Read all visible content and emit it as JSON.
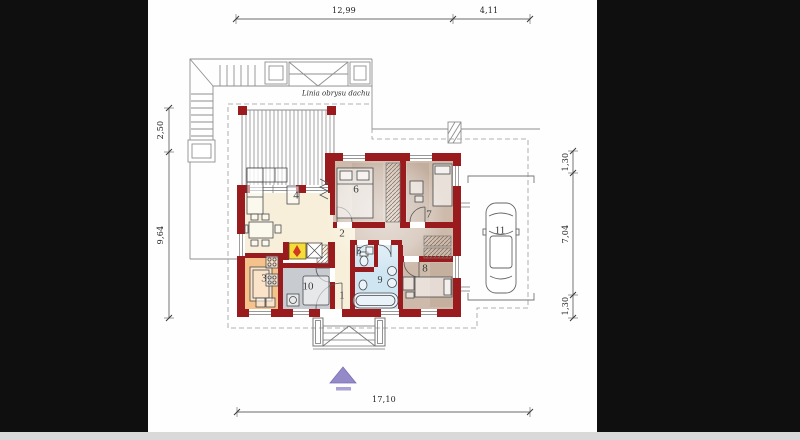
{
  "sheet": {
    "type": "architectural-floor-plan",
    "background": "#0f0f0f",
    "paper": "#fefefe",
    "bottom_strip": "#d9d9d9"
  },
  "palette": {
    "wall_red": "#9a1b1e",
    "floor_cream": "#f7efd9",
    "floor_tan": "#cdbaab",
    "floor_orange": "#f5c28b",
    "floor_gray": "#c8ccd1",
    "floor_blue": "#cfe5f2",
    "fireplace_yellow": "#f4dd3b",
    "flame_red": "#d03a1e",
    "arrow_purple": "#938ac7",
    "line_gray": "#8f8f8f"
  },
  "annotations": {
    "roof_outline_label": "Linia obrysu dachu"
  },
  "dimensions": {
    "top": [
      {
        "label": "12,99"
      },
      {
        "label": "4,11"
      }
    ],
    "left": [
      {
        "label": "2,50"
      },
      {
        "label": "9,64"
      }
    ],
    "right": [
      {
        "label": "1,30"
      },
      {
        "label": "7,04"
      },
      {
        "label": "1,30"
      }
    ],
    "bottom": [
      {
        "label": "17,10"
      }
    ]
  },
  "rooms": [
    {
      "number": "1"
    },
    {
      "number": "2"
    },
    {
      "number": "3"
    },
    {
      "number": "4"
    },
    {
      "number": "5"
    },
    {
      "number": "6"
    },
    {
      "number": "7"
    },
    {
      "number": "8"
    },
    {
      "number": "9"
    },
    {
      "number": "10"
    },
    {
      "number": "11"
    }
  ]
}
